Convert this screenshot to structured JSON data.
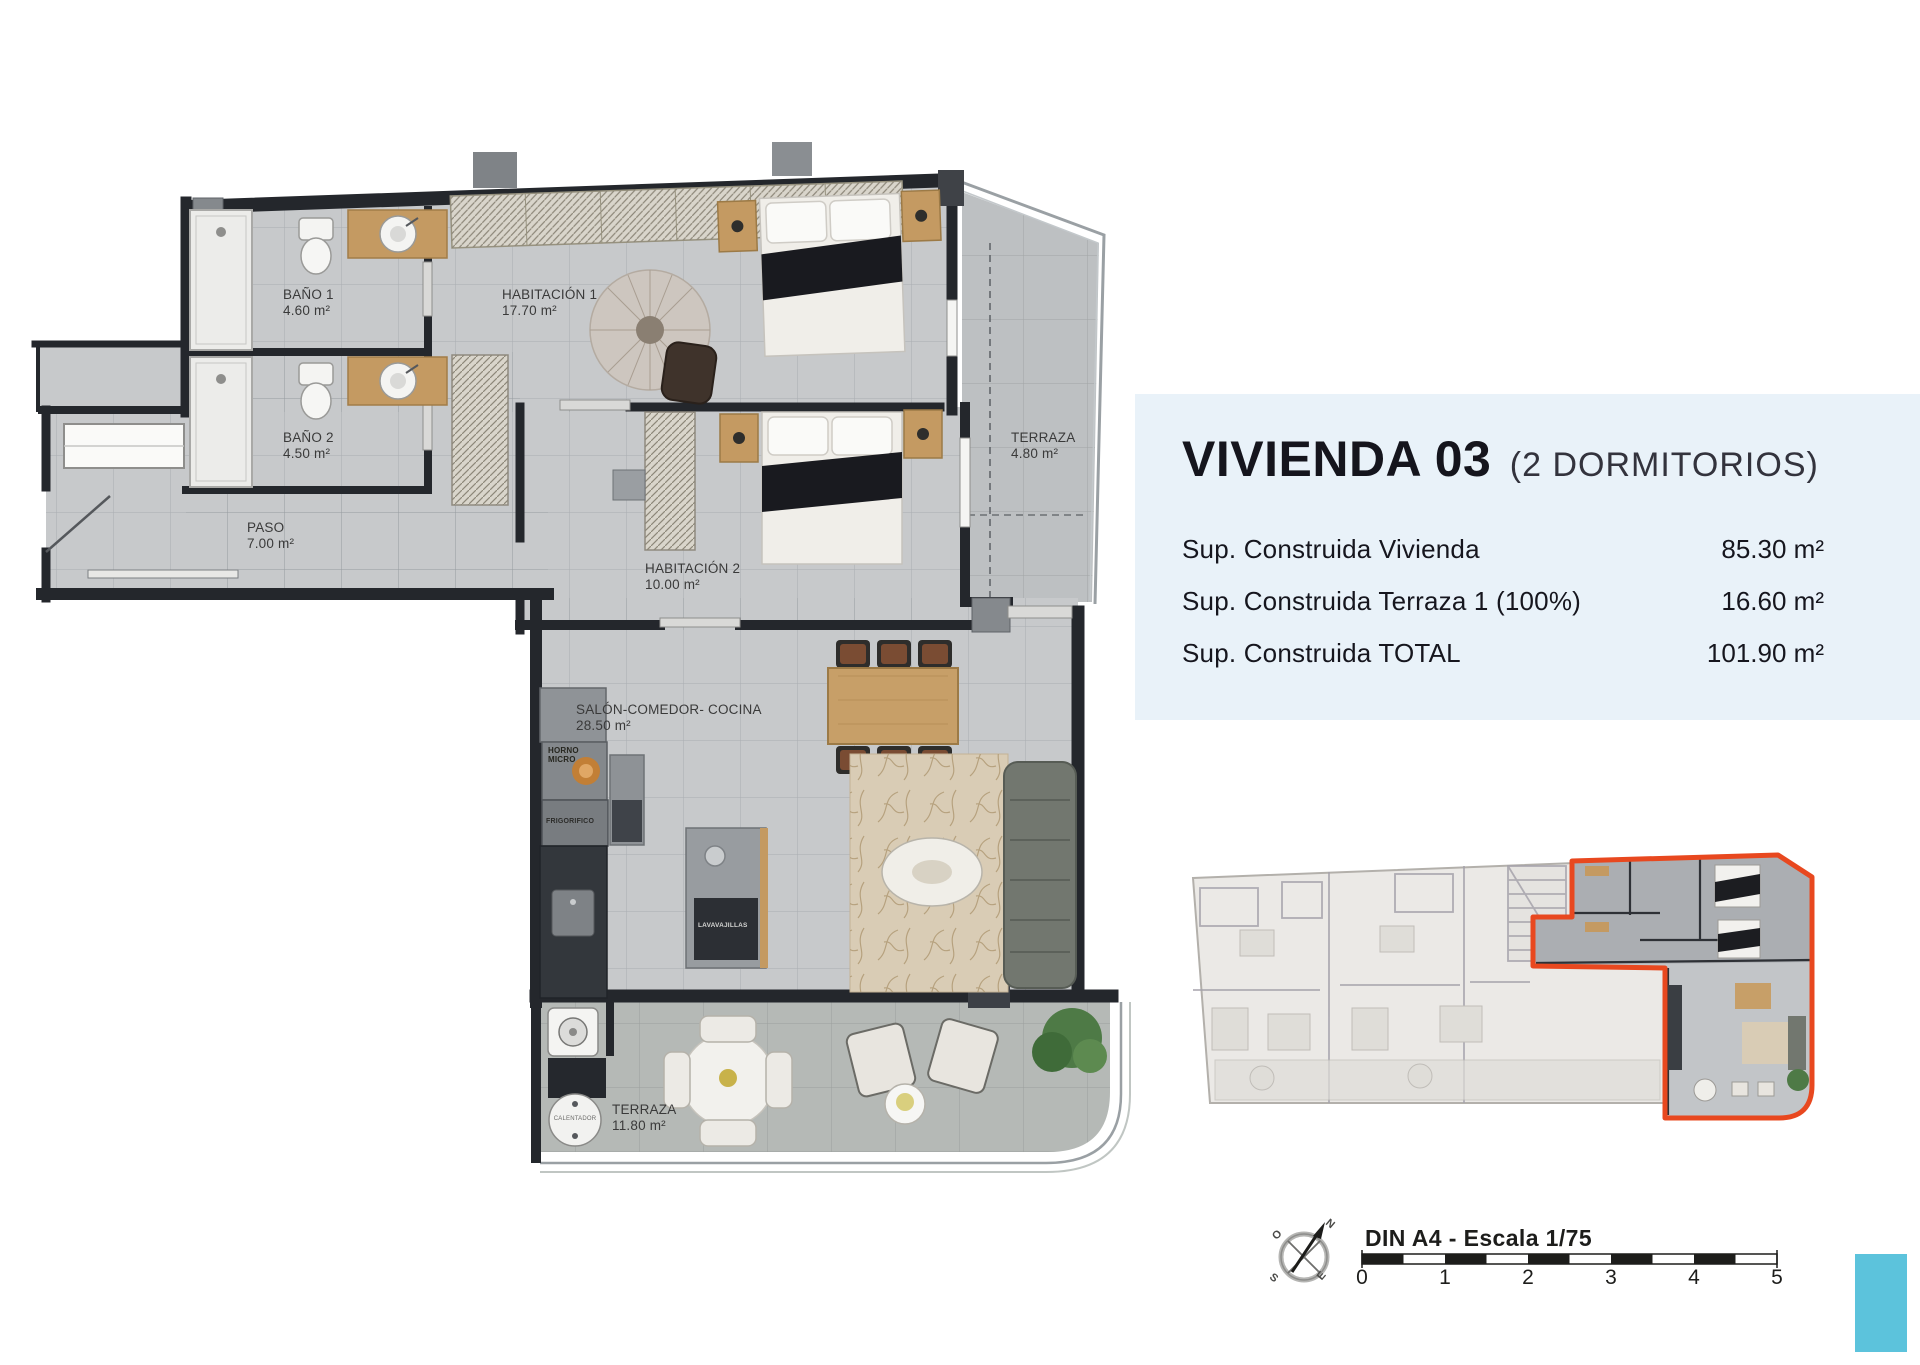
{
  "panel": {
    "title": "VIVIENDA 03",
    "subtitle": "(2 DORMITORIOS)",
    "rows": [
      {
        "label": "Sup. Construida Vivienda",
        "value": "85.30 m²"
      },
      {
        "label": "Sup. Construida Terraza 1 (100%)",
        "value": "16.60 m²"
      },
      {
        "label": "Sup. Construida TOTAL",
        "value": "101.90 m²"
      }
    ]
  },
  "plan": {
    "rooms": [
      {
        "name": "BAÑO 1",
        "area": "4.60 m²"
      },
      {
        "name": "HABITACIÓN 1",
        "area": "17.70 m²"
      },
      {
        "name": "BAÑO 2",
        "area": "4.50 m²"
      },
      {
        "name": "PASO",
        "area": "7.00 m²"
      },
      {
        "name": "HABITACIÓN 2",
        "area": "10.00 m²"
      },
      {
        "name": "TERRAZA",
        "area": "4.80 m²"
      },
      {
        "name": "SALÓN-COMEDOR- COCINA",
        "area": "28.50 m²"
      },
      {
        "name": "TERRAZA",
        "area": "11.80 m²"
      }
    ],
    "appliances": {
      "horno_line1": "HORNO",
      "horno_line2": "MICRO",
      "frigorifico": "FRIGORIFICO",
      "lavavajillas": "LAVAVAJILLAS",
      "calentador": "CALENTADOR"
    }
  },
  "compass": {
    "n": "N",
    "o": "O",
    "s": "S",
    "e": "E"
  },
  "scalebar": {
    "title": "DIN A4 - Escala 1/75",
    "ticks": [
      "0",
      "1",
      "2",
      "3",
      "4",
      "5"
    ]
  },
  "colors": {
    "highlight_red": "#e8481f",
    "accent_blue": "#5cc3dc",
    "panel_bg": "#e9f2f9",
    "wall": "#24272c",
    "floor": "#c7c9cb"
  }
}
